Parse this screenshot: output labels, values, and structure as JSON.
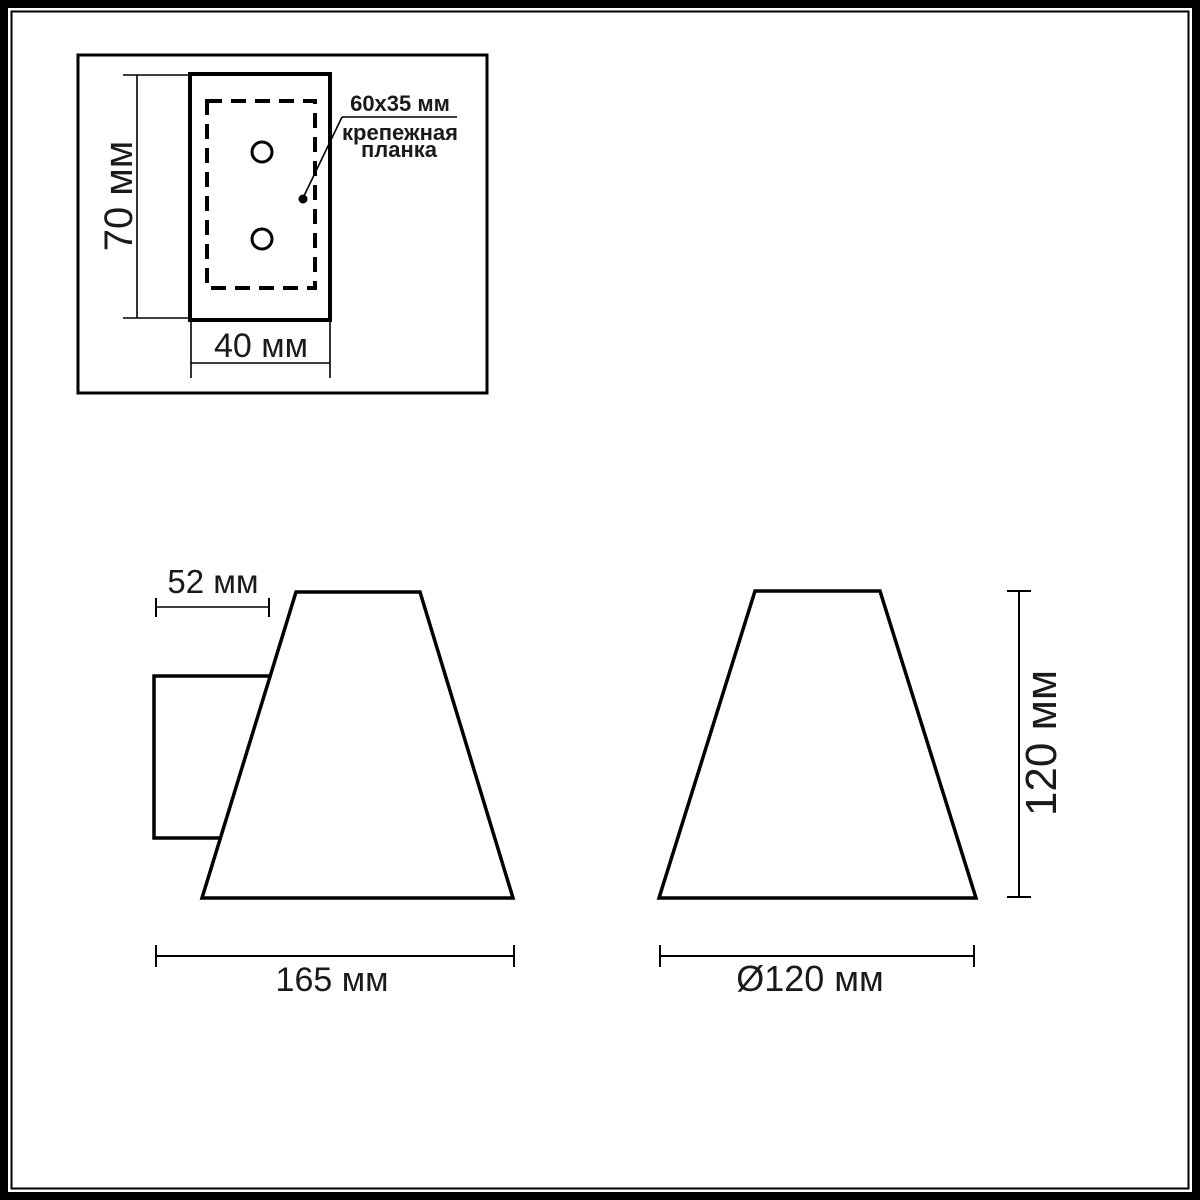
{
  "colors": {
    "line": "#000000",
    "background": "#ffffff",
    "text": "#1a1a1a"
  },
  "detail_view": {
    "height_dim": "70 мм",
    "width_dim": "40 мм",
    "bracket_size": "60x35 мм",
    "bracket_label_line1": "крепежная",
    "bracket_label_line2": "планка"
  },
  "side_view": {
    "bracket_depth_dim": "52 мм",
    "overall_width_dim": "165 мм"
  },
  "front_view": {
    "height_dim": "120 мм",
    "diameter_dim": "Ø120 мм"
  }
}
